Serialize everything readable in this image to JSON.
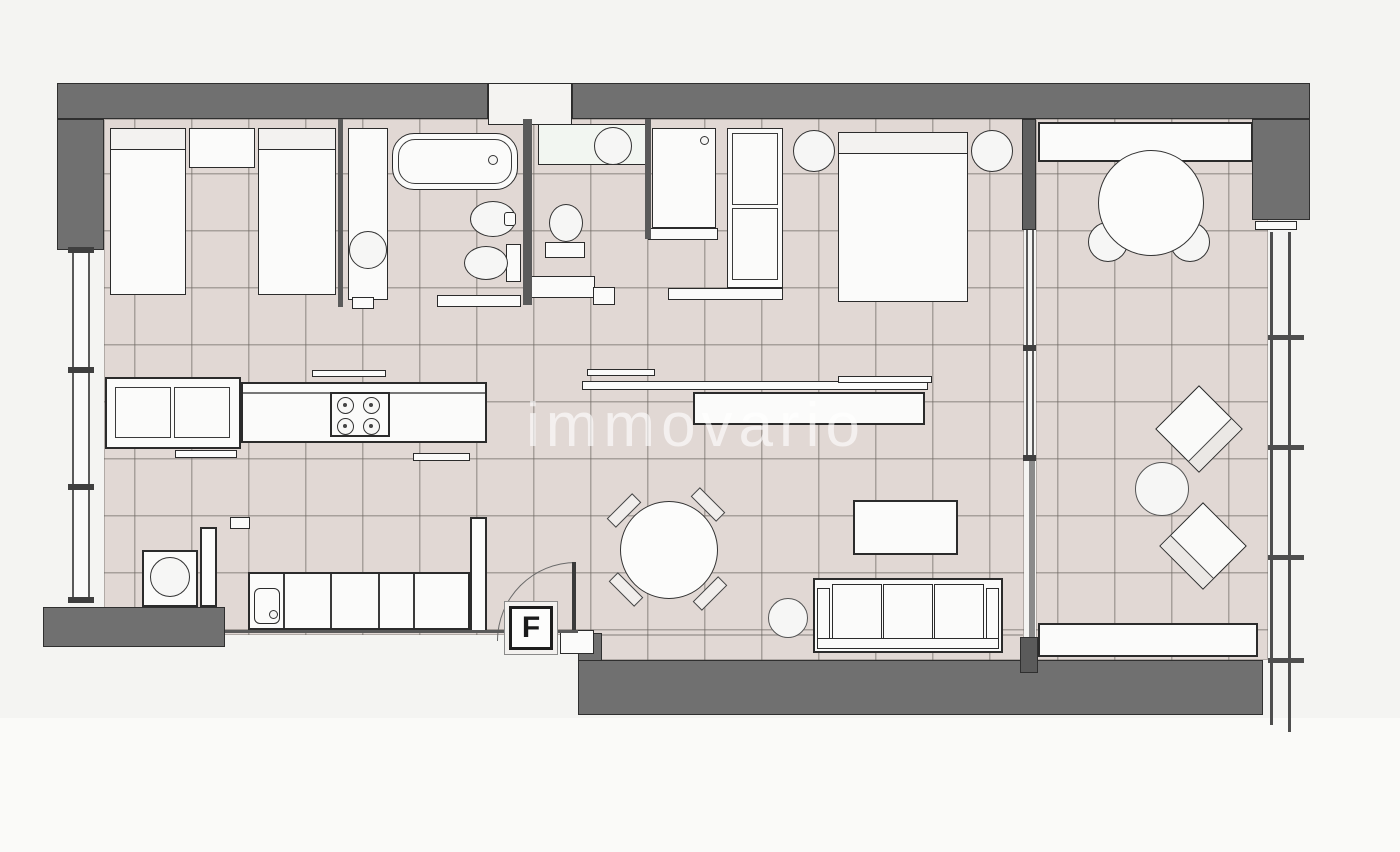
{
  "plan": {
    "watermark": "immovario",
    "entrance_label": "F"
  },
  "colors": {
    "background": "#f4f4f2",
    "outside_lower": "#fafaf8",
    "wall": "#707070",
    "wall_outline": "#2f2f2f",
    "floor_tile": "#e1d8d4",
    "tile_grid": "rgba(110,103,98,0.5)",
    "fixture_fill": "#fbfbfa",
    "fixture_border": "#2b2b2b",
    "glass_line": "#5a5a5a",
    "railing": "#4e4e4e",
    "watermark_color": "rgba(255,255,255,0.62)"
  }
}
